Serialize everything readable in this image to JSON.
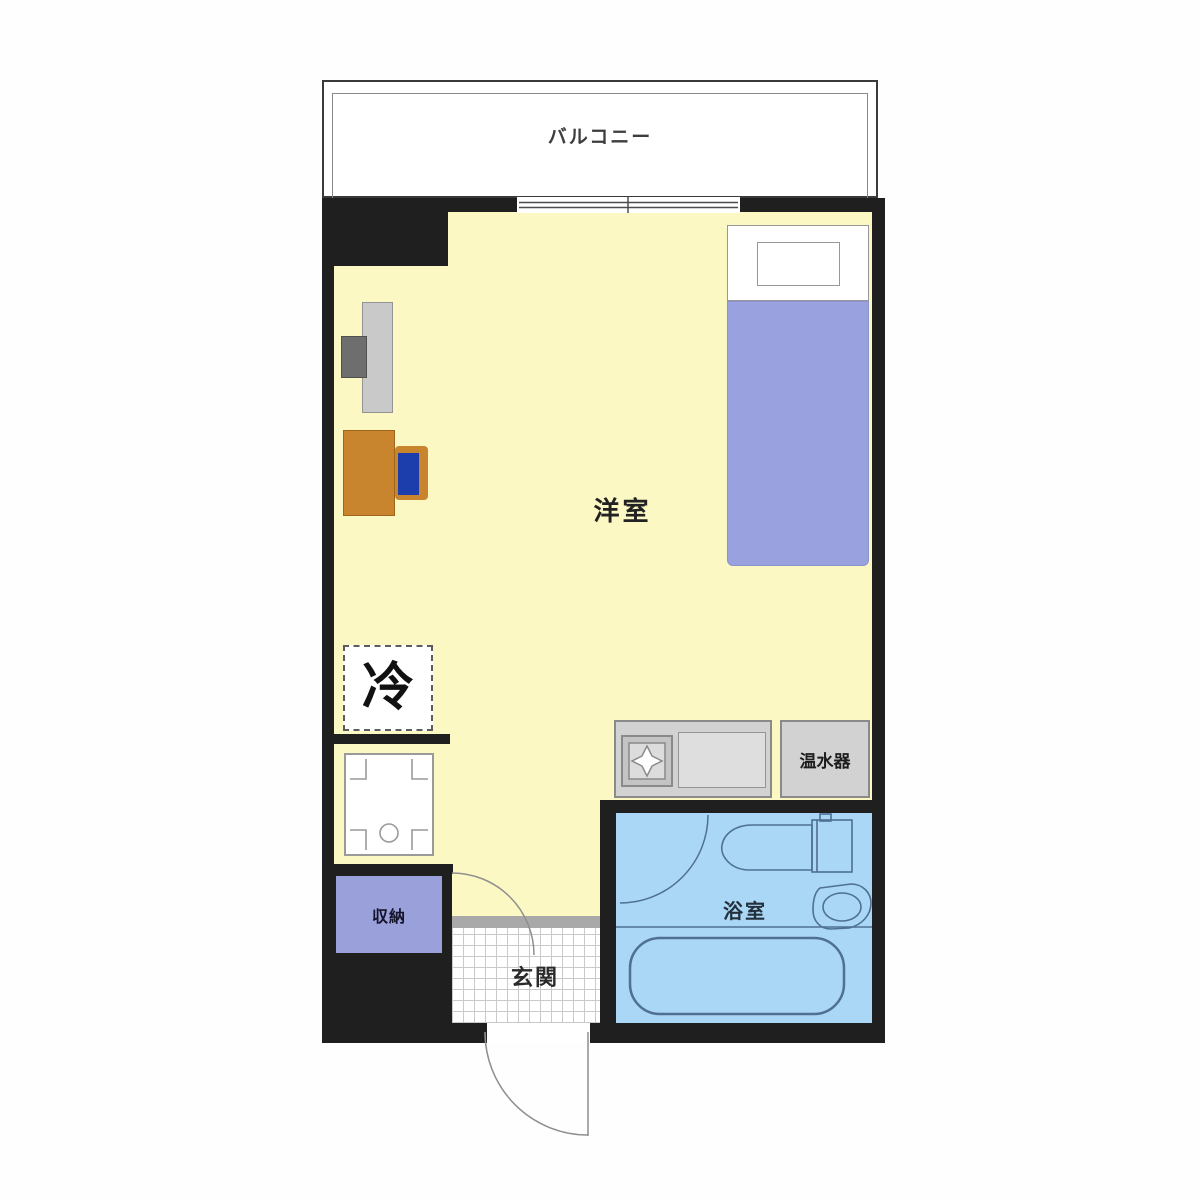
{
  "plan": {
    "type": "apartment-floor-plan",
    "labels": {
      "balcony": "バルコニー",
      "living_room": "洋室",
      "refrigerator": "冷",
      "storage": "収納",
      "entrance": "玄関",
      "bathroom": "浴室",
      "water_heater": "温水器"
    },
    "colors": {
      "wall": "#1f1f1f",
      "floor": "#fbf8c3",
      "bed": "#99a2de",
      "storage": "#9aa0d9",
      "bathroom": "#a9d7f5",
      "counter": "#d2d2d2",
      "desk": "#c8852e",
      "chair": "#1c3ead"
    },
    "icons": [
      "bed-icon",
      "pillow-icon",
      "tv-icon",
      "desk-icon",
      "chair-icon",
      "refrigerator-space-icon",
      "washing-machine-pan-icon",
      "stove-icon",
      "kitchen-sink-icon",
      "water-heater-icon",
      "toilet-icon",
      "washbasin-icon",
      "bathtub-icon",
      "door-swing-arc-icon",
      "sliding-window-icon"
    ]
  }
}
